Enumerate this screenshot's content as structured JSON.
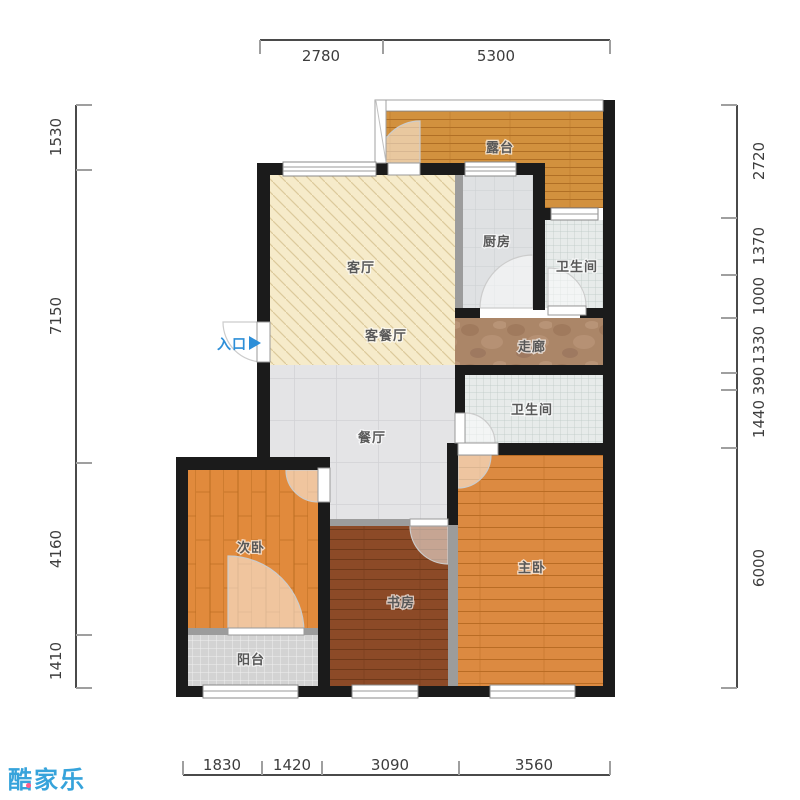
{
  "brand": {
    "logo_text": "酷家乐"
  },
  "plan": {
    "entrance_label": "入口",
    "rooms": {
      "terrace": "露台",
      "kitchen": "厨房",
      "bathroom1": "卫生间",
      "living": "客厅",
      "living_dining": "客餐厅",
      "corridor": "走廊",
      "bathroom2": "卫生间",
      "dining": "餐厅",
      "second_bedroom": "次卧",
      "master_bedroom": "主卧",
      "study": "书房",
      "balcony": "阳台"
    },
    "dimensions_mm": {
      "top": [
        "2780",
        "5300"
      ],
      "bottom": [
        "1830",
        "1420",
        "3090",
        "3560"
      ],
      "left": [
        "1530",
        "7150",
        "4160",
        "1410"
      ],
      "right": [
        "2720",
        "1370",
        "1000",
        "1330",
        "390",
        "1440",
        "6000"
      ]
    },
    "colors": {
      "wall": "#1b1b1b",
      "terrace_wood": "#d2913e",
      "bedroom_wood": "#dc8a41",
      "study_wood": "#8c4a27",
      "living_hatch": "#f6ebca",
      "tile_gray": "#e4e4e6",
      "corridor_marble": "#ab8668",
      "entrance_blue": "#2e8fd8",
      "logo_blue": "#36a3db"
    }
  }
}
